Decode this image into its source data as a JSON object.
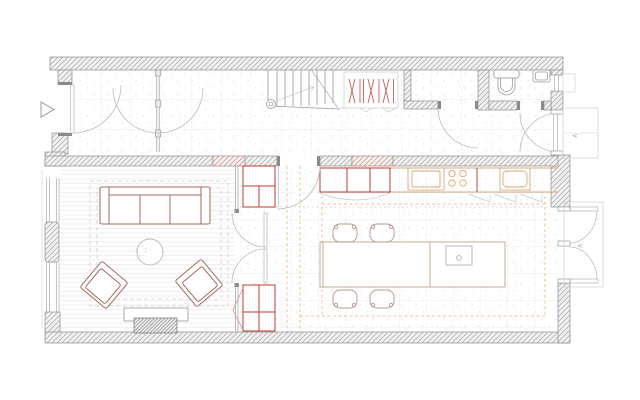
{
  "drawing": {
    "type": "architectural-floor-plan",
    "symbols": {
      "door_direction_glyph": "<"
    }
  },
  "colors": {
    "background": "#ffffff",
    "wall_hatch": "#a6a6a6",
    "wall_fill": "#f1f1f1",
    "wall_edge": "#8f8f8f",
    "new_work_red": "#c0392f",
    "red_hatch": "#d4837c",
    "furniture": "#a5695e",
    "kitchen_counter": "#d8ab7c",
    "cooktop_ring": "#e0a86a",
    "island_outline": "#bfa58b",
    "chair_outline": "#b5988c",
    "orange_guide": "#e2ad6d",
    "door_arc": "#bdbdbd",
    "floor_grid": "#e9e9e9",
    "wood_line": "#e9e7e4",
    "landing_outline": "#d4d4d4",
    "hanger_red": "#c75f55"
  },
  "elements": {
    "rooms": [
      "entrance-hall",
      "staircase",
      "coat-closet",
      "storage",
      "wc",
      "living-room",
      "kitchen-dining"
    ],
    "fixtures": [
      "entry-marker",
      "front-door",
      "stair-flight",
      "coat-hangers",
      "toilet",
      "wash-basin",
      "sofa",
      "armchair",
      "coffee-table",
      "fireplace",
      "built-in-cabinet",
      "double-doors",
      "kitchen-counter",
      "cooktop",
      "kitchen-sink",
      "island-dining-table",
      "island-sink",
      "dining-chair",
      "french-doors",
      "exterior-landing"
    ]
  }
}
